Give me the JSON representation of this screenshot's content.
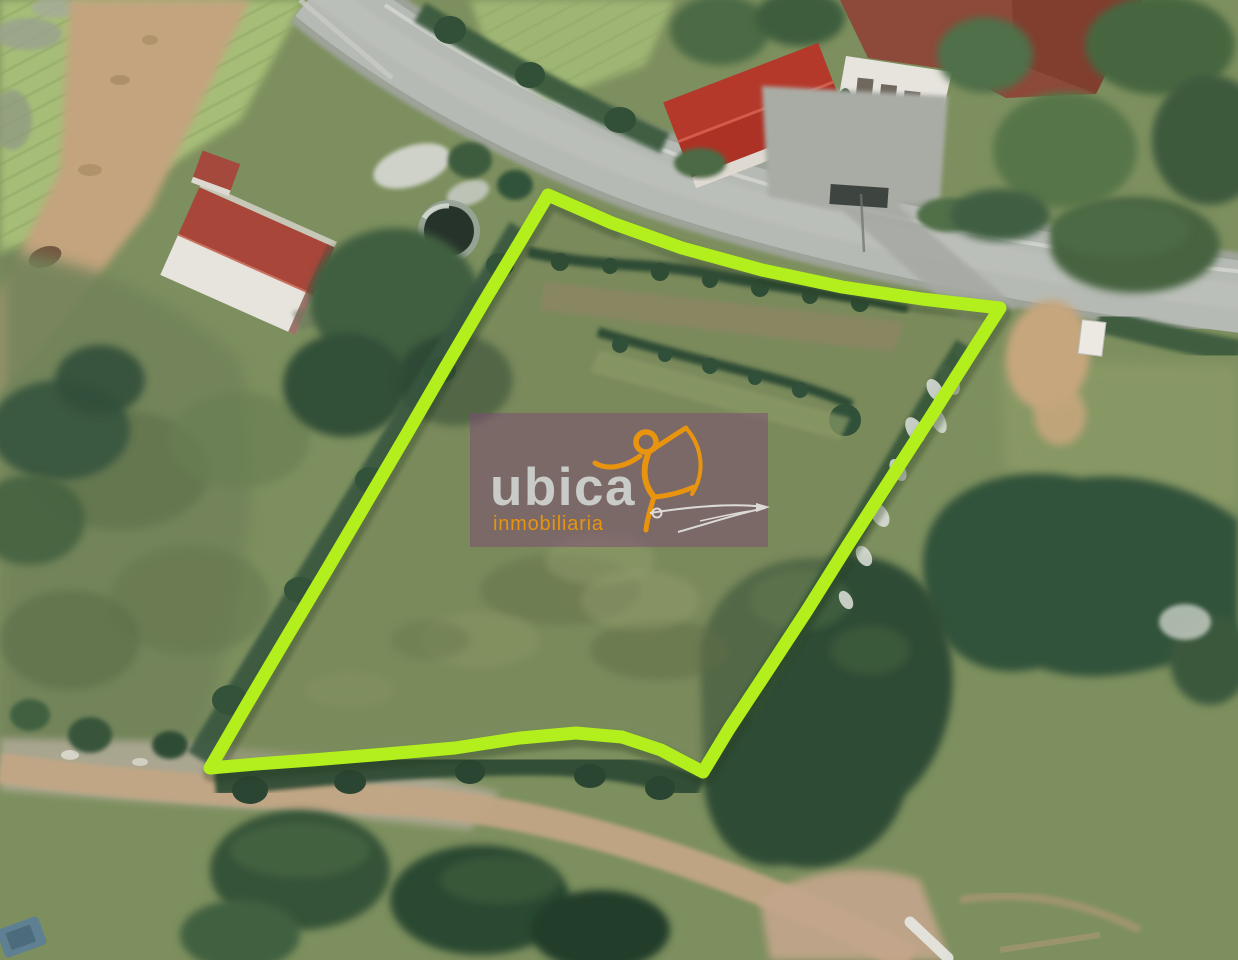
{
  "watermark": {
    "brand": "ubica",
    "tagline": "inmobiliaria",
    "brand_color": "#c9cbc8",
    "tagline_color": "#e8940f",
    "figure_color": "#e8940f",
    "panel_color": "#7c4a74"
  },
  "overlay": {
    "boundary_color": "#b2ef1c"
  }
}
